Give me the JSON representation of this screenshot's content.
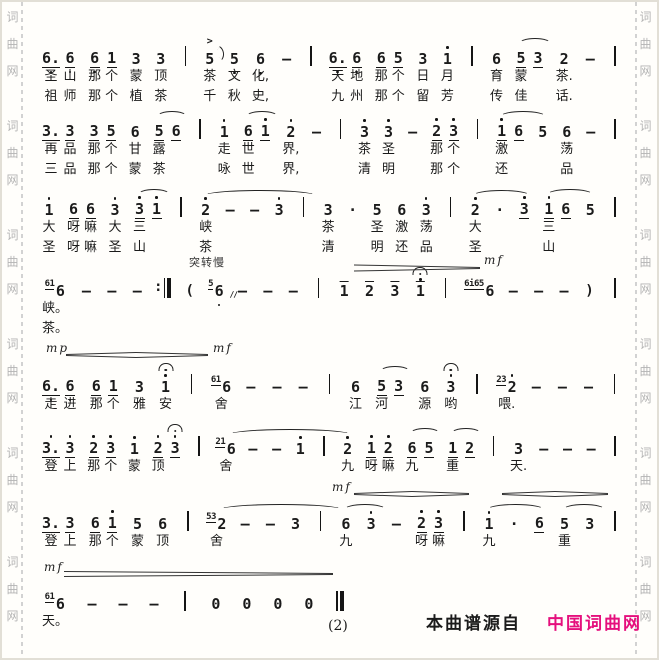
{
  "page": {
    "watermark_chars": [
      "词",
      "曲",
      "网"
    ],
    "watermark_repeats": 6
  },
  "footer": {
    "page_number": "(2)",
    "source_prefix": "本曲谱源自",
    "source_name": "中国词曲网",
    "source_color": "#e5107d"
  },
  "score": {
    "tempo_mark": "突转慢",
    "dynamics": [
      {
        "y": 266,
        "segs": [
          [
            352,
            478,
            6,
            1
          ]
        ],
        "labels": [
          {
            "t": "mf",
            "x": 482,
            "y": 262
          }
        ]
      },
      {
        "y": 353,
        "segs": [
          [
            64,
            134,
            1,
            5
          ],
          [
            134,
            206,
            5,
            1
          ]
        ],
        "labels": [
          {
            "t": "mp",
            "x": 44,
            "y": 350
          },
          {
            "t": "mf",
            "x": 211,
            "y": 350
          }
        ]
      },
      {
        "y": 492,
        "segs": [
          [
            352,
            410,
            1,
            5
          ],
          [
            410,
            467,
            5,
            1
          ],
          [
            500,
            553,
            1,
            5
          ],
          [
            553,
            606,
            5,
            1
          ]
        ],
        "labels": [
          {
            "t": "mf",
            "x": 330,
            "y": 489
          }
        ]
      },
      {
        "y": 572,
        "segs": [
          [
            62,
            331,
            5,
            1
          ]
        ],
        "labels": [
          {
            "t": "mf",
            "x": 42,
            "y": 569
          }
        ]
      }
    ],
    "systems": [
      {
        "top": 40,
        "two": true,
        "cells": [
          {
            "grp": [
              {
                "n": "6.",
                "u": 1,
                "db": 1,
                "l1": "圣",
                "l2": "祖"
              },
              {
                "n": "6",
                "u": 1,
                "db": 1,
                "l1": "山",
                "l2": "师"
              }
            ]
          },
          {
            "grp": [
              {
                "n": "6",
                "u": 1,
                "db": 1,
                "l1": "那",
                "l2": "那"
              },
              {
                "n": "1",
                "u": 1,
                "l1": "个",
                "l2": "个"
              }
            ]
          },
          {
            "n": "3",
            "l1": "蒙",
            "l2": "植"
          },
          {
            "n": "3",
            "l1": "顶",
            "l2": "茶"
          },
          {
            "b": "single"
          },
          {
            "n": "5",
            "a": 1,
            "fl": 1,
            "l1": "茶",
            "l2": "千"
          },
          {
            "n": "5",
            "db": 1,
            "l1": "文",
            "l2": "秋"
          },
          {
            "n": "6",
            "db": 1,
            "l1": "化,",
            "l2": "史,"
          },
          {
            "n": "—"
          },
          {
            "b": "single"
          },
          {
            "grp": [
              {
                "n": "6.",
                "u": 1,
                "db": 1,
                "l1": "天",
                "l2": "九"
              },
              {
                "n": "6",
                "u": 1,
                "db": 1,
                "l1": "地",
                "l2": "州"
              }
            ]
          },
          {
            "grp": [
              {
                "n": "6",
                "u": 1,
                "l1": "那",
                "l2": "那"
              },
              {
                "n": "5",
                "u": 1,
                "l1": "个",
                "l2": "个"
              }
            ]
          },
          {
            "n": "3",
            "l1": "日",
            "l2": "留"
          },
          {
            "n": "1",
            "da": 1,
            "l1": "月",
            "l2": "芳"
          },
          {
            "b": "single"
          },
          {
            "n": "6",
            "l1": "育",
            "l2": "传"
          },
          {
            "grp": [
              {
                "n": "5",
                "u": 1,
                "sw": 30,
                "l1": "蒙",
                "l2": "佳"
              },
              {
                "n": "3",
                "u": 1
              }
            ]
          },
          {
            "n": "2",
            "l1": "茶.",
            "l2": "话."
          },
          {
            "n": "—"
          },
          {
            "b": "single"
          }
        ]
      },
      {
        "top": 113,
        "two": true,
        "cells": [
          {
            "grp": [
              {
                "n": "3.",
                "u": 1,
                "l1": "再",
                "l2": "三"
              },
              {
                "n": "3",
                "u": 1,
                "l1": "品",
                "l2": "品"
              }
            ]
          },
          {
            "grp": [
              {
                "n": "3",
                "u": 1,
                "l1": "那",
                "l2": "那"
              },
              {
                "n": "5",
                "u": 1,
                "l1": "个",
                "l2": "个"
              }
            ]
          },
          {
            "n": "6",
            "l1": "甘",
            "l2": "蒙"
          },
          {
            "grp": [
              {
                "n": "5",
                "u": 1,
                "sw": 28,
                "l1": "露",
                "l2": "茶"
              },
              {
                "n": "6",
                "u": 1
              }
            ]
          },
          {
            "b": "single"
          },
          {
            "n": "1",
            "da": 1,
            "l1": "走",
            "l2": "咏"
          },
          {
            "grp": [
              {
                "n": "6",
                "u": 1,
                "sw": 30,
                "l1": "世",
                "l2": "世"
              },
              {
                "n": "1",
                "u": 1,
                "da": 1
              }
            ]
          },
          {
            "n": "2",
            "da": 1,
            "l1": "界,",
            "l2": "界,"
          },
          {
            "n": "—"
          },
          {
            "b": "single"
          },
          {
            "n": "3",
            "da": 1,
            "l1": "茶",
            "l2": "清"
          },
          {
            "n": "3",
            "da": 1,
            "l1": "圣",
            "l2": "明"
          },
          {
            "n": "—"
          },
          {
            "grp": [
              {
                "n": "2",
                "u": 1,
                "da": 1,
                "l1": "那",
                "l2": "那"
              },
              {
                "n": "3",
                "u": 1,
                "da": 1,
                "l1": "个",
                "l2": "个"
              }
            ]
          },
          {
            "b": "single"
          },
          {
            "grp": [
              {
                "n": "1",
                "u": 1,
                "da": 1,
                "sw": 44,
                "l1": "激",
                "l2": "还"
              },
              {
                "n": "6",
                "u": 1
              }
            ]
          },
          {
            "n": "5"
          },
          {
            "n": "6",
            "l1": "荡",
            "l2": "品"
          },
          {
            "n": "—"
          },
          {
            "b": "single"
          }
        ]
      },
      {
        "top": 191,
        "two": true,
        "cells": [
          {
            "n": "1",
            "da": 1,
            "l1": "大",
            "l2": "圣"
          },
          {
            "grp": [
              {
                "n": "6",
                "u": 1,
                "l1": "呀",
                "l2": "呀"
              },
              {
                "n": "6",
                "u": 1,
                "l1": "嘛",
                "l2": "嘛"
              }
            ]
          },
          {
            "n": "3",
            "da": 1,
            "l1": "大",
            "l2": "圣"
          },
          {
            "grp": [
              {
                "n": "3",
                "u": 1,
                "da": 1,
                "sw": 30,
                "l1": "三",
                "l2": "山"
              },
              {
                "n": "1",
                "u": 1,
                "da": 1
              }
            ]
          },
          {
            "b": "single"
          },
          {
            "n": "2",
            "da": 1,
            "sw": 110,
            "l1": "峡",
            "l2": "茶"
          },
          {
            "n": "—"
          },
          {
            "n": "—"
          },
          {
            "n": "3",
            "da": 1
          },
          {
            "b": "single"
          },
          {
            "n": "3",
            "l1": "茶",
            "l2": "清"
          },
          {
            "n": "·"
          },
          {
            "n": "5",
            "l1": "圣",
            "l2": "明"
          },
          {
            "n": "6",
            "l1": "激",
            "l2": "还"
          },
          {
            "n": "3",
            "da": 1,
            "l1": "荡",
            "l2": "品"
          },
          {
            "b": "single"
          },
          {
            "n": "2",
            "da": 1,
            "sw": 55,
            "l1": "大",
            "l2": "圣"
          },
          {
            "n": "·"
          },
          {
            "n": "3",
            "u": 1,
            "da": 1
          },
          {
            "grp": [
              {
                "n": "1",
                "u": 1,
                "da": 1,
                "sw": 44,
                "l1": "三",
                "l2": "山"
              },
              {
                "n": "6",
                "u": 1
              }
            ]
          },
          {
            "n": "5"
          },
          {
            "b": "single"
          }
        ]
      },
      {
        "top": 272,
        "two": true,
        "cells": [
          {
            "n": "6",
            "gr": "61",
            "l1": "峡。",
            "l2": "茶。"
          },
          {
            "n": "—"
          },
          {
            "n": "—"
          },
          {
            "n": "—"
          },
          {
            "b": "repeat"
          },
          {
            "n": "(",
            "tx": 1
          },
          {
            "n": "6",
            "gr": "5",
            "db": 1,
            "sl": 1
          },
          {
            "n": "—"
          },
          {
            "n": "—"
          },
          {
            "n": "—"
          },
          {
            "b": "single"
          },
          {
            "n": "1",
            "ol": 1
          },
          {
            "n": "2",
            "ol": 1
          },
          {
            "n": "3",
            "ol": 1
          },
          {
            "n": "1",
            "ol": 1,
            "da": 1,
            "f": 1
          },
          {
            "b": "single"
          },
          {
            "n": "6",
            "gr": "6i65"
          },
          {
            "n": "—"
          },
          {
            "n": "—"
          },
          {
            "n": "—"
          },
          {
            "n": ")",
            "tx": 1
          },
          {
            "b": "single"
          }
        ]
      },
      {
        "top": 368,
        "cells": [
          {
            "grp": [
              {
                "n": "6.",
                "u": 1,
                "db": 1,
                "l1": "走"
              },
              {
                "n": "6",
                "u": 1,
                "db": 1,
                "l1": "进"
              }
            ]
          },
          {
            "grp": [
              {
                "n": "6",
                "u": 1,
                "db": 1,
                "l1": "那"
              },
              {
                "n": "1",
                "u": 1,
                "l1": "个"
              }
            ]
          },
          {
            "n": "3",
            "l1": "雅"
          },
          {
            "n": "1",
            "da": 1,
            "f": 1,
            "l1": "安"
          },
          {
            "b": "single"
          },
          {
            "n": "6",
            "gr": "61",
            "l1": "舍"
          },
          {
            "n": "—"
          },
          {
            "n": "—"
          },
          {
            "n": "—"
          },
          {
            "b": "single"
          },
          {
            "n": "6",
            "l1": "江"
          },
          {
            "grp": [
              {
                "n": "5",
                "u": 1,
                "sw": 28,
                "l1": "河"
              },
              {
                "n": "3",
                "u": 1
              }
            ]
          },
          {
            "n": "6",
            "l1": "源"
          },
          {
            "n": "3",
            "da": 1,
            "f": 1,
            "l1": "哟"
          },
          {
            "b": "single"
          },
          {
            "n": "2",
            "gr": "23",
            "da": 1,
            "l1": "喂."
          },
          {
            "n": "—"
          },
          {
            "n": "—"
          },
          {
            "n": "—"
          },
          {
            "b": "single"
          }
        ]
      },
      {
        "top": 430,
        "cells": [
          {
            "grp": [
              {
                "n": "3.",
                "u": 1,
                "da": 1,
                "l1": "登"
              },
              {
                "n": "3",
                "u": 1,
                "da": 1,
                "l1": "上"
              }
            ]
          },
          {
            "grp": [
              {
                "n": "2",
                "u": 1,
                "da": 1,
                "l1": "那"
              },
              {
                "n": "3",
                "u": 1,
                "da": 1,
                "l1": "个"
              }
            ]
          },
          {
            "n": "1",
            "da": 1,
            "l1": "蒙"
          },
          {
            "grp": [
              {
                "n": "2",
                "u": 1,
                "da": 1,
                "l1": "顶"
              },
              {
                "n": "3",
                "u": 1,
                "da": 1,
                "f": 1
              }
            ]
          },
          {
            "b": "single"
          },
          {
            "n": "6",
            "gr": "21",
            "sw": 120,
            "l1": "舍"
          },
          {
            "n": "—"
          },
          {
            "n": "—"
          },
          {
            "n": "1",
            "da": 1
          },
          {
            "b": "single"
          },
          {
            "n": "2",
            "da": 1,
            "l1": "九"
          },
          {
            "grp": [
              {
                "n": "1",
                "u": 1,
                "da": 1,
                "l1": "呀"
              },
              {
                "n": "2",
                "u": 1,
                "da": 1,
                "l1": "嘛"
              }
            ]
          },
          {
            "grp": [
              {
                "n": "6",
                "u": 1,
                "sw": 28,
                "l1": "九"
              },
              {
                "n": "5",
                "u": 1
              }
            ]
          },
          {
            "grp": [
              {
                "n": "1",
                "u": 1,
                "sw": 28,
                "l1": "重"
              },
              {
                "n": "2",
                "u": 1
              }
            ]
          },
          {
            "b": "single"
          },
          {
            "n": "3",
            "l1": "天."
          },
          {
            "n": "—"
          },
          {
            "n": "—"
          },
          {
            "n": "—"
          },
          {
            "b": "single"
          }
        ]
      },
      {
        "top": 505,
        "cells": [
          {
            "grp": [
              {
                "n": "3.",
                "u": 1,
                "l1": "登"
              },
              {
                "n": "3",
                "u": 1,
                "l1": "上"
              }
            ]
          },
          {
            "grp": [
              {
                "n": "6",
                "u": 1,
                "l1": "那"
              },
              {
                "n": "1",
                "u": 1,
                "da": 1,
                "l1": "个"
              }
            ]
          },
          {
            "n": "5",
            "l1": "蒙"
          },
          {
            "n": "6",
            "l1": "顶"
          },
          {
            "b": "single"
          },
          {
            "n": "2",
            "gr": "53",
            "sw": 120,
            "l1": "舍"
          },
          {
            "n": "—"
          },
          {
            "n": "—"
          },
          {
            "n": "3"
          },
          {
            "b": "single"
          },
          {
            "n": "6",
            "sw": 40,
            "l1": "九"
          },
          {
            "n": "3",
            "da": 1
          },
          {
            "n": "—"
          },
          {
            "grp": [
              {
                "n": "2",
                "u": 1,
                "da": 1,
                "l1": "呀"
              },
              {
                "n": "3",
                "u": 1,
                "da": 1,
                "l1": "嘛"
              }
            ]
          },
          {
            "b": "single"
          },
          {
            "n": "1",
            "da": 1,
            "sw": 55,
            "l1": "九"
          },
          {
            "n": "·"
          },
          {
            "n": "6",
            "u": 1
          },
          {
            "n": "5",
            "sw": 40,
            "l1": "重"
          },
          {
            "n": "3"
          },
          {
            "b": "single"
          }
        ]
      },
      {
        "top": 585,
        "width": 305,
        "cells": [
          {
            "n": "6",
            "gr": "61",
            "l1": "天。"
          },
          {
            "n": "—"
          },
          {
            "n": "—"
          },
          {
            "n": "—"
          },
          {
            "b": "single"
          },
          {
            "n": "0"
          },
          {
            "n": "0"
          },
          {
            "n": "0"
          },
          {
            "n": "0"
          },
          {
            "b": "final"
          }
        ]
      }
    ]
  }
}
